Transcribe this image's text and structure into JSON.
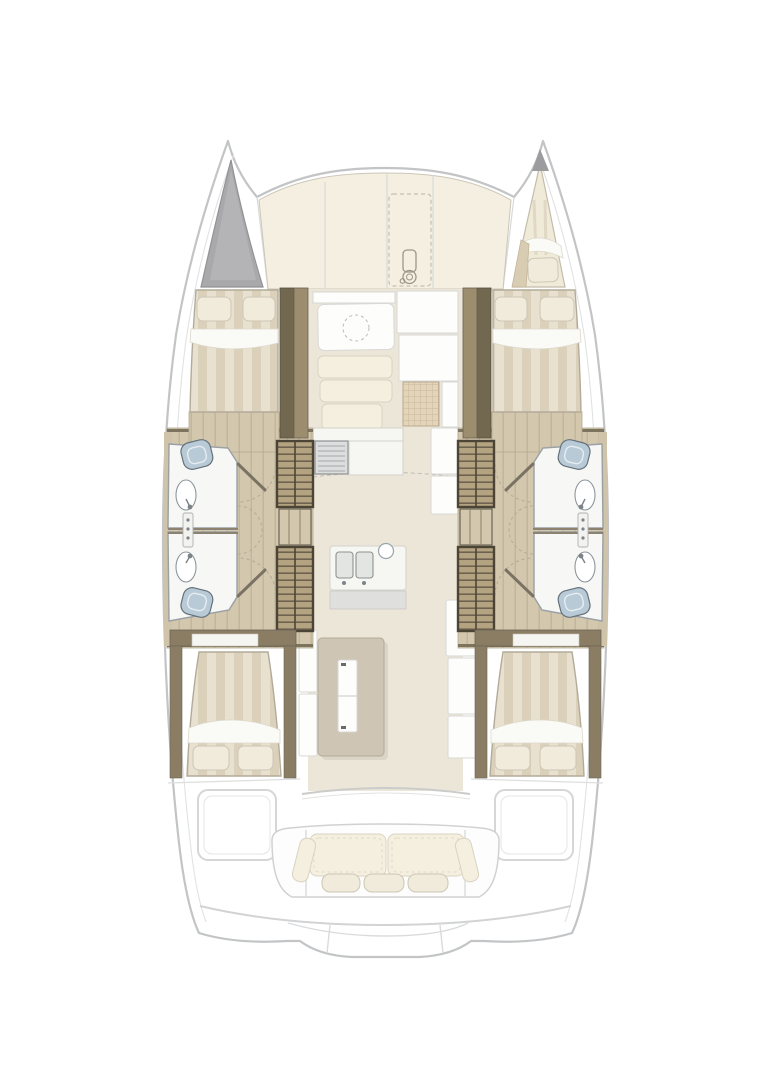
{
  "page": {
    "background": "#ffffff"
  },
  "palette": {
    "hullLine": "#c2c4c6",
    "deckPanel": "#f4efe0",
    "deckLine": "#cbc7b9",
    "bowGray": "#a9a9ab",
    "woodDark": "#72684f",
    "woodMid": "#9b8d6d",
    "woodFloor": "#d3c7ad",
    "stairSlat": "#b3a380",
    "stairFrame": "#4c4435",
    "bedStripeA": "#e9e1cf",
    "bedStripeB": "#dbd1bb",
    "pillow": "#f1ebdb",
    "sheet": "#fafaf7",
    "bathFloor": "#f7f8f6",
    "bathLine": "#9aa0a5",
    "fixtureBlue": "#b9cad7",
    "fixtureLine": "#64707a",
    "salonFloor": "#ece6d8",
    "galleyCounter": "#f6f6f3",
    "islandFill": "#cec5b4",
    "matFill": "#e3d4ba",
    "benchCushion": "#f4efdf",
    "cockpitLine": "#d2d3d4"
  },
  "plan": {
    "vessel": "catamaran-floor-plan",
    "areas": [
      {
        "id": "foredeck",
        "features": [
          "sun-pad-panels",
          "dashed-hatch-panel",
          "windlass-icon"
        ]
      },
      {
        "id": "port-bow-locker",
        "features": [
          "gray-storage-triangle"
        ]
      },
      {
        "id": "starboard-bow-berth",
        "features": [
          "single-berth",
          "pillow"
        ]
      },
      {
        "id": "port-forward-cabin",
        "features": [
          "double-bed",
          "two-pillows",
          "wood-partition"
        ]
      },
      {
        "id": "starboard-forward-cabin",
        "features": [
          "double-bed",
          "two-pillows",
          "wood-partition"
        ]
      },
      {
        "id": "port-heads-forward",
        "features": [
          "toilet",
          "sink",
          "shower-column",
          "door-swing-arc"
        ]
      },
      {
        "id": "port-heads-aft",
        "features": [
          "toilet",
          "sink",
          "shower-column",
          "door-swing-arc"
        ]
      },
      {
        "id": "starboard-heads-forward",
        "features": [
          "toilet",
          "sink",
          "shower-column",
          "door-swing-arc"
        ]
      },
      {
        "id": "starboard-heads-aft",
        "features": [
          "toilet",
          "sink",
          "shower-column",
          "door-swing-arc"
        ]
      },
      {
        "id": "port-companionway",
        "features": [
          "upper-stairs",
          "landing",
          "lower-stairs"
        ]
      },
      {
        "id": "starboard-companionway",
        "features": [
          "upper-stairs",
          "landing",
          "lower-stairs"
        ]
      },
      {
        "id": "salon",
        "features": [
          "table",
          "dashed-circle",
          "l-bench-cushions",
          "grid-mat",
          "white-panels"
        ]
      },
      {
        "id": "galley",
        "features": [
          "stove",
          "counters",
          "double-sink",
          "round-basin",
          "island",
          "fridge-unit"
        ]
      },
      {
        "id": "port-aft-cabin",
        "features": [
          "double-bed",
          "two-pillows",
          "wood-frame"
        ]
      },
      {
        "id": "starboard-aft-cabin",
        "features": [
          "double-bed",
          "two-pillows",
          "wood-frame"
        ]
      },
      {
        "id": "aft-deck",
        "features": [
          "port-hatch",
          "starboard-hatch"
        ]
      },
      {
        "id": "cockpit",
        "features": [
          "bench",
          "back-cushions",
          "three-pillows"
        ]
      },
      {
        "id": "stern-platform",
        "features": [
          "transom-curves",
          "swim-steps"
        ]
      }
    ]
  }
}
